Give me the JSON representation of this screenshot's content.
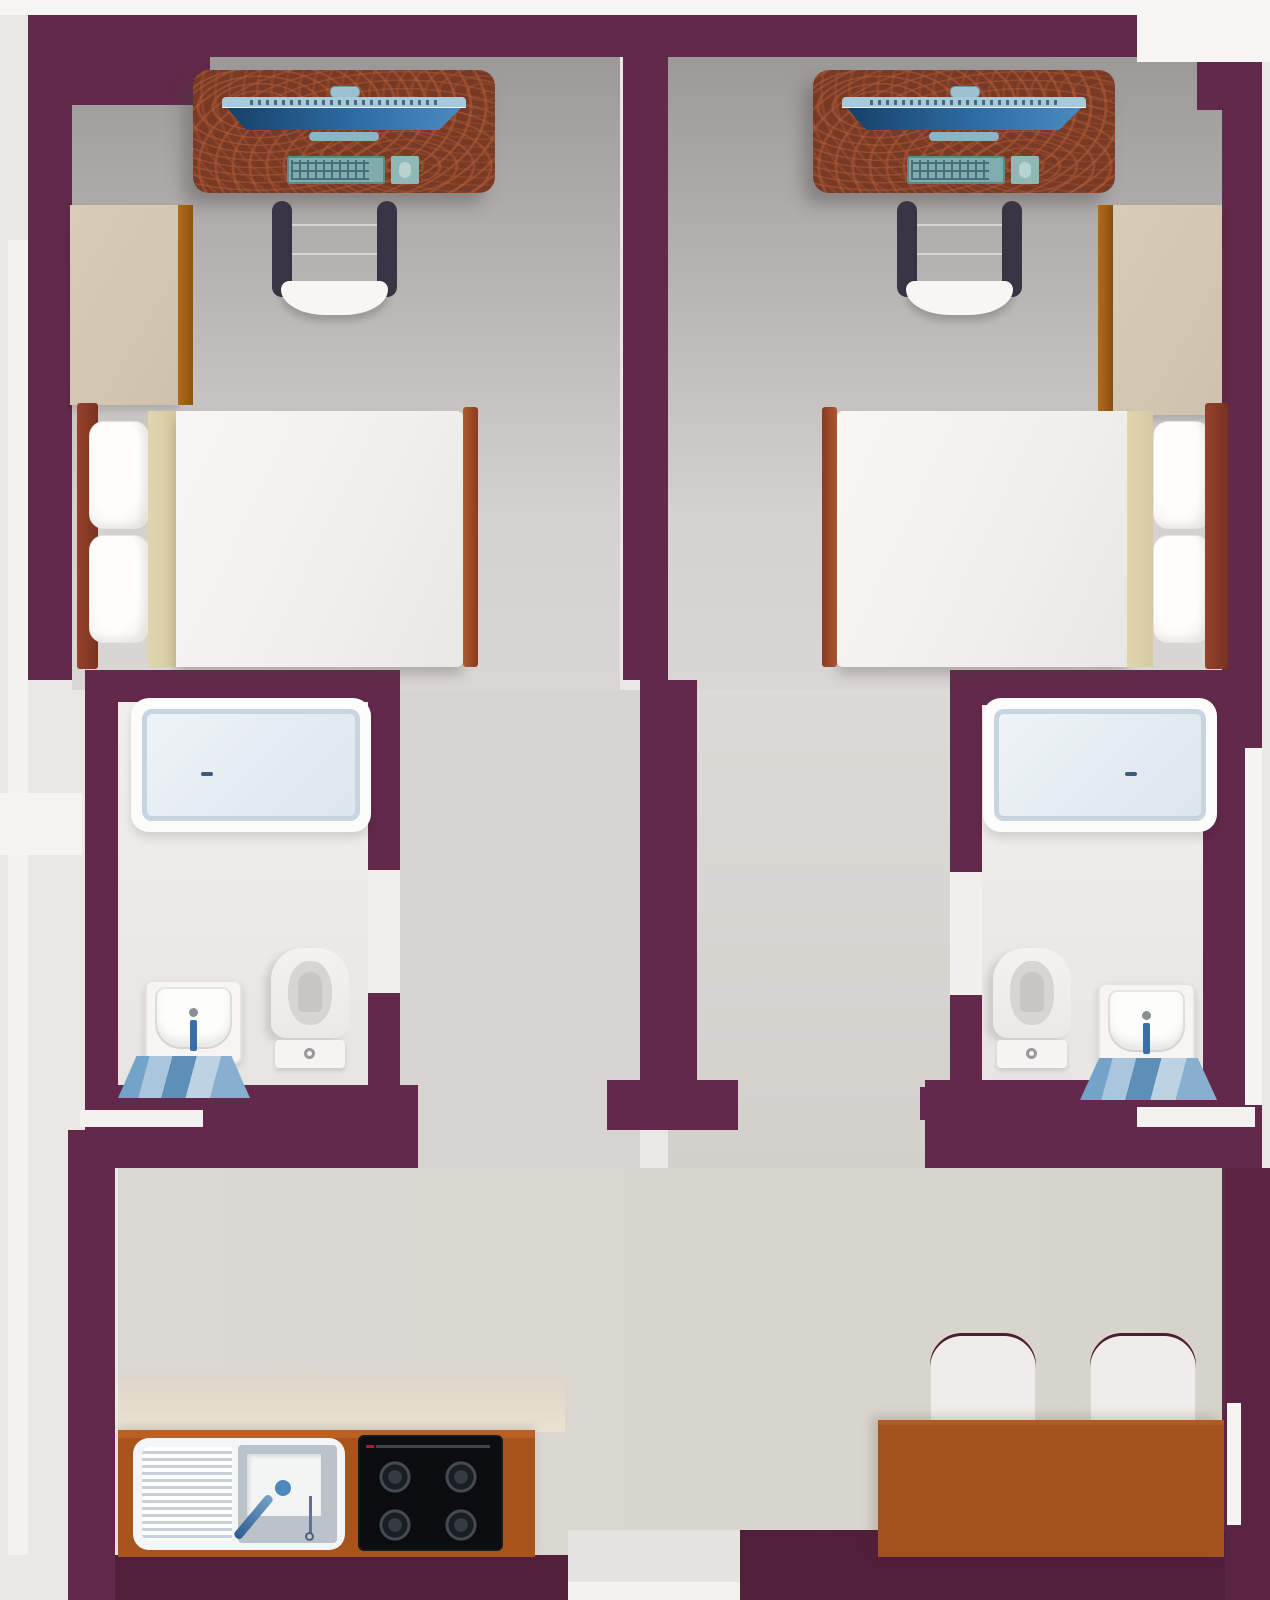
{
  "scene": {
    "type": "architectural floor plan, top-down 2D illustration",
    "title": "Twin studio apartments with shared kitchen and dining area",
    "units": [
      {
        "id": "left",
        "name": "Left studio unit",
        "workstation": {
          "desk": "wooden computer desk",
          "monitor": "widescreen monitor (top view)",
          "webcam": "webcam",
          "keyboard": "keyboard",
          "mousepad": "mouse pad with mouse",
          "chair": "office chair with armrests"
        },
        "wardrobe": "wardrobe closet with wooden trim",
        "bed": {
          "label": "double bed with wooden head and foot boards",
          "pillows": 2,
          "throw": "beige blanket fold"
        },
        "bathroom": {
          "label": "en-suite bathroom",
          "shower": "walk-in shower tray with drain",
          "sink": "washbasin with faucet",
          "toilet": "toilet with cistern and flush button",
          "mat": "blue striped bath mat"
        }
      },
      {
        "id": "right",
        "name": "Right studio unit (mirrored)",
        "workstation": {
          "desk": "wooden computer desk",
          "monitor": "widescreen monitor (top view)",
          "webcam": "webcam",
          "keyboard": "keyboard",
          "mousepad": "mouse pad with mouse",
          "chair": "office chair with armrests"
        },
        "wardrobe": "wardrobe closet with wooden trim",
        "bed": {
          "label": "double bed with wooden head and foot boards",
          "pillows": 2,
          "throw": "beige blanket fold"
        },
        "bathroom": {
          "label": "en-suite bathroom",
          "shower": "walk-in shower tray with drain",
          "sink": "washbasin with faucet",
          "toilet": "toilet with cistern and flush button",
          "mat": "blue striped bath mat"
        }
      }
    ],
    "shared": {
      "corridor": "central corridor between units",
      "living": "shared lower living space",
      "kitchen": {
        "counter": "wooden kitchen counter",
        "sink": "kitchen sink with ribbed drainboard and faucet",
        "stove": "black 4-burner cooktop",
        "burners": 4
      },
      "dining": {
        "table": "wooden dining table",
        "chairs": 2
      }
    },
    "palette": {
      "wall": "#63294a",
      "wall_dark": "#521f3b",
      "floor_light": "#d8d5d2",
      "floor_dark": "#9c9999",
      "bathroom_floor": "#f0eeec",
      "accent_white": "#f7f5f3",
      "desk_wood": "#793a25",
      "counter_wood": "#a8541d",
      "bed_wood": "#8a3a22",
      "wardrobe": "#d5c8b3",
      "wardrobe_trim": "#a05e14",
      "screen_blue": "#2e6da4",
      "device_teal": "#7fadab",
      "shower_tray": "#e3ebf1",
      "mat_blue": "#7ea7c9",
      "duvet": "#f4f2ee",
      "table_wood": "#a3521e",
      "stove_black": "#0c0d10"
    }
  }
}
